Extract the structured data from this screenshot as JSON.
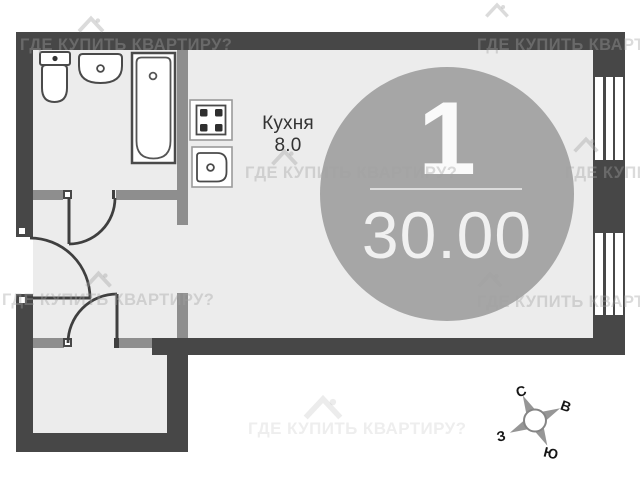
{
  "title": "apartment-floor-plan",
  "kitchen": {
    "label": "Кухня",
    "area": "8.0"
  },
  "badge": {
    "rooms_count": "1",
    "total_area": "30.00"
  },
  "compass": {
    "north": "С",
    "east": "В",
    "south": "Ю",
    "west": "З"
  },
  "watermark": {
    "text": "ГДЕ КУПИТЬ КВАРТИРУ?",
    "icon": "house-roof-icon"
  },
  "rooms": [
    {
      "name": "bathroom",
      "fixtures": [
        "toilet",
        "washbasin",
        "bathtub"
      ]
    },
    {
      "name": "kitchen-living-room",
      "fixtures": [
        "stove-4-burner",
        "kitchen-sink"
      ]
    },
    {
      "name": "entrance-hall"
    },
    {
      "name": "storage-room"
    }
  ],
  "windows_on_right_wall": 2,
  "door_count": 3,
  "colors": {
    "outer_wall": "#474747",
    "partition": "#8e8e8e",
    "floor": "#ececec",
    "badge_circle": "#a6a6a6",
    "badge_text": "#fafafa",
    "line": "#3f3f3f",
    "watermark": "#a0a0a0"
  }
}
